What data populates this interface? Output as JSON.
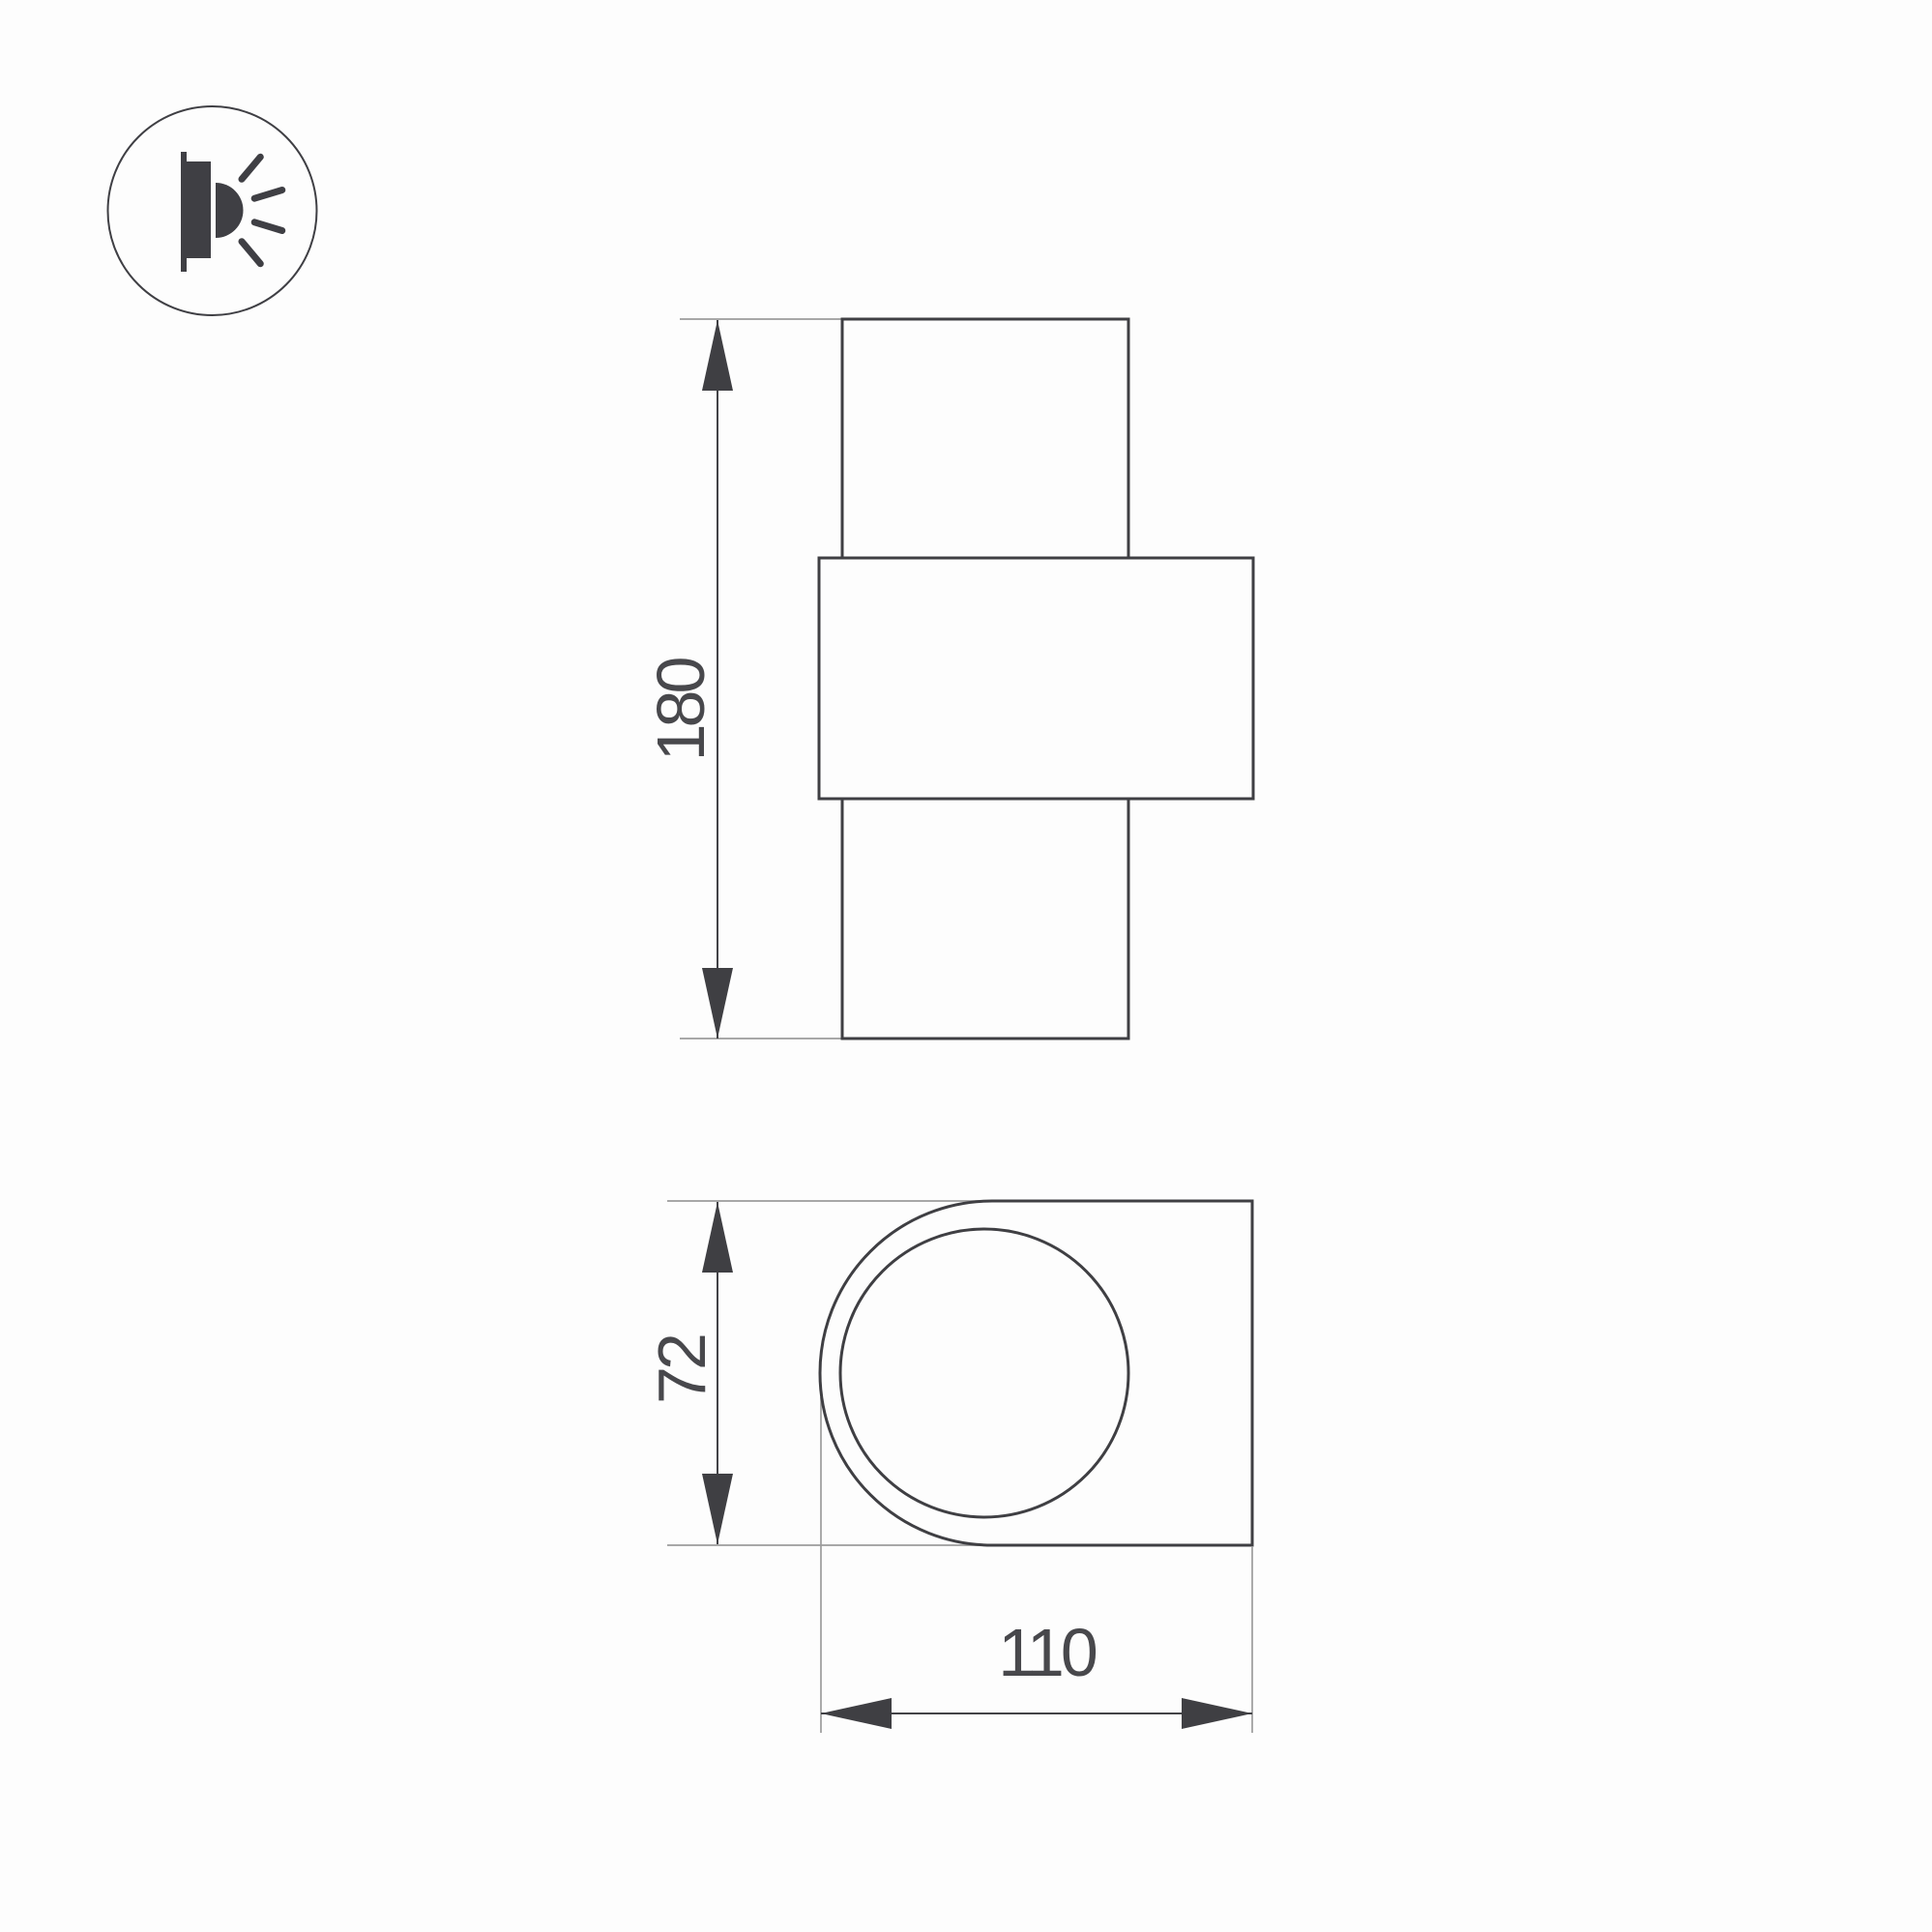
{
  "icon": {
    "name": "wall-light-side-emission-icon"
  },
  "dimensions": {
    "height": {
      "value": "180"
    },
    "depth": {
      "value": "72"
    },
    "width": {
      "value": "110"
    }
  },
  "colors": {
    "background": "#fdfdfd",
    "body_outline": "#3f3f43",
    "dimension_lines": "#434347",
    "extension_lines": "#9c9c9c",
    "text": "#48484c",
    "icon": "#3f3f44"
  }
}
